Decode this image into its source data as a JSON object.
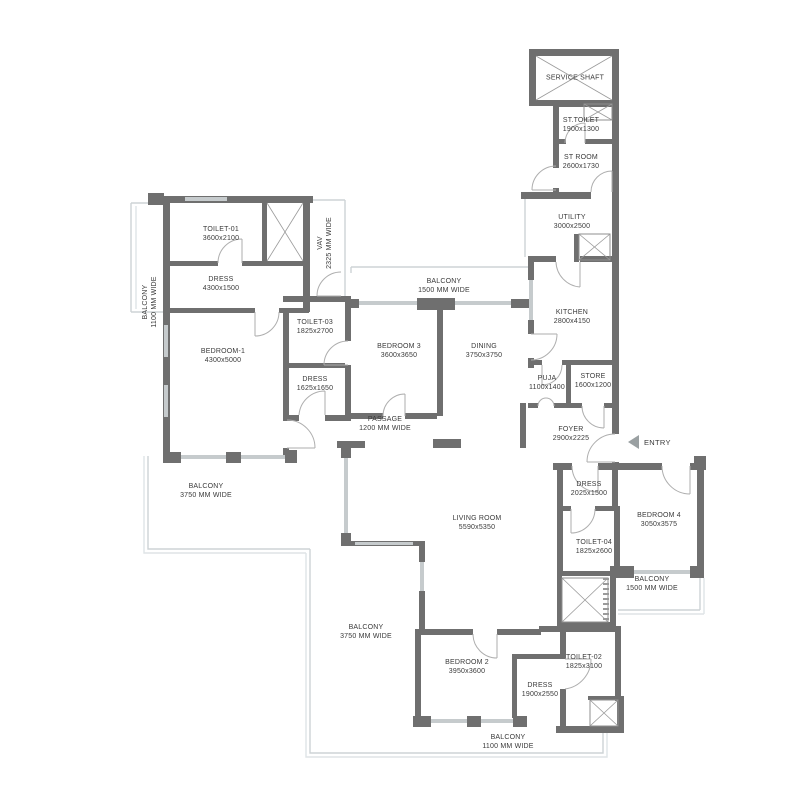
{
  "plan": {
    "colors": {
      "wall": "#6f6f6f",
      "window": "#c6cbcd",
      "railing": "#cdd3d5",
      "door_arc": "#aeaeae",
      "text": "#3a3a3a",
      "background": "#ffffff"
    },
    "entry": {
      "label": "ENTRY"
    },
    "rooms": [
      {
        "id": "service-shaft",
        "name": "SERVICE SHAFT",
        "dims": "",
        "x": 575,
        "y": 78,
        "rotate": 0
      },
      {
        "id": "st-toilet",
        "name": "ST.TOILET",
        "dims": "1900x1300",
        "x": 581,
        "y": 125,
        "rotate": 0
      },
      {
        "id": "st-room",
        "name": "ST ROOM",
        "dims": "2600x1730",
        "x": 581,
        "y": 162,
        "rotate": 0
      },
      {
        "id": "utility",
        "name": "UTILITY",
        "dims": "3000x2500",
        "x": 572,
        "y": 222,
        "rotate": 0
      },
      {
        "id": "kitchen",
        "name": "KITCHEN",
        "dims": "2800x4150",
        "x": 572,
        "y": 317,
        "rotate": 0
      },
      {
        "id": "toilet-01",
        "name": "TOILET-01",
        "dims": "3600x2100",
        "x": 221,
        "y": 234,
        "rotate": 0
      },
      {
        "id": "dress-toilet01",
        "name": "DRESS",
        "dims": "4300x1500",
        "x": 221,
        "y": 284,
        "rotate": 0
      },
      {
        "id": "vav-shaft",
        "name": "VAV",
        "dims": "2325 MM WIDE",
        "x": 325,
        "y": 243,
        "rotate": -90
      },
      {
        "id": "balcony-west-narrow",
        "name": "BALCONY",
        "dims": "1100 MM WIDE",
        "x": 150,
        "y": 302,
        "rotate": -90
      },
      {
        "id": "bedroom-1",
        "name": "BEDROOM-1",
        "dims": "4300x5000",
        "x": 223,
        "y": 356,
        "rotate": 0
      },
      {
        "id": "toilet-03",
        "name": "TOILET-03",
        "dims": "1825x2700",
        "x": 315,
        "y": 327,
        "rotate": 0
      },
      {
        "id": "dress-toilet03",
        "name": "DRESS",
        "dims": "1625x1650",
        "x": 315,
        "y": 384,
        "rotate": 0
      },
      {
        "id": "balcony-north",
        "name": "BALCONY",
        "dims": "1500 MM WIDE",
        "x": 444,
        "y": 286,
        "rotate": 0
      },
      {
        "id": "bedroom-3",
        "name": "BEDROOM 3",
        "dims": "3600x3650",
        "x": 399,
        "y": 351,
        "rotate": 0
      },
      {
        "id": "dining",
        "name": "DINING",
        "dims": "3750x3750",
        "x": 484,
        "y": 351,
        "rotate": 0
      },
      {
        "id": "puja",
        "name": "PUJA",
        "dims": "1100x1400",
        "x": 547,
        "y": 383,
        "rotate": 0
      },
      {
        "id": "store",
        "name": "STORE",
        "dims": "1600x1200",
        "x": 593,
        "y": 381,
        "rotate": 0
      },
      {
        "id": "passage",
        "name": "PASSAGE",
        "dims": "1200 MM WIDE",
        "x": 385,
        "y": 424,
        "rotate": 0
      },
      {
        "id": "foyer",
        "name": "FOYER",
        "dims": "2900x2225",
        "x": 571,
        "y": 434,
        "rotate": 0
      },
      {
        "id": "balcony-west",
        "name": "BALCONY",
        "dims": "3750 MM WIDE",
        "x": 206,
        "y": 491,
        "rotate": 0
      },
      {
        "id": "living-room",
        "name": "LIVING ROOM",
        "dims": "5590x5350",
        "x": 477,
        "y": 523,
        "rotate": 0
      },
      {
        "id": "dress-bedroom4",
        "name": "DRESS",
        "dims": "2025x1500",
        "x": 589,
        "y": 489,
        "rotate": 0
      },
      {
        "id": "bedroom-4",
        "name": "BEDROOM 4",
        "dims": "3050x3575",
        "x": 659,
        "y": 520,
        "rotate": 0
      },
      {
        "id": "toilet-04",
        "name": "TOILET-04",
        "dims": "1825x2600",
        "x": 594,
        "y": 547,
        "rotate": 0
      },
      {
        "id": "balcony-east",
        "name": "BALCONY",
        "dims": "1500 MM WIDE",
        "x": 652,
        "y": 584,
        "rotate": 0
      },
      {
        "id": "balcony-south",
        "name": "BALCONY",
        "dims": "3750 MM WIDE",
        "x": 366,
        "y": 632,
        "rotate": 0
      },
      {
        "id": "bedroom-2",
        "name": "BEDROOM 2",
        "dims": "3950x3600",
        "x": 467,
        "y": 667,
        "rotate": 0
      },
      {
        "id": "dress-bedroom2",
        "name": "DRESS",
        "dims": "1900x2550",
        "x": 540,
        "y": 690,
        "rotate": 0
      },
      {
        "id": "toilet-02",
        "name": "TOILET-02",
        "dims": "1825x3100",
        "x": 584,
        "y": 662,
        "rotate": 0
      },
      {
        "id": "balcony-bottom",
        "name": "BALCONY",
        "dims": "1100 MM WIDE",
        "x": 508,
        "y": 742,
        "rotate": 0
      }
    ]
  }
}
